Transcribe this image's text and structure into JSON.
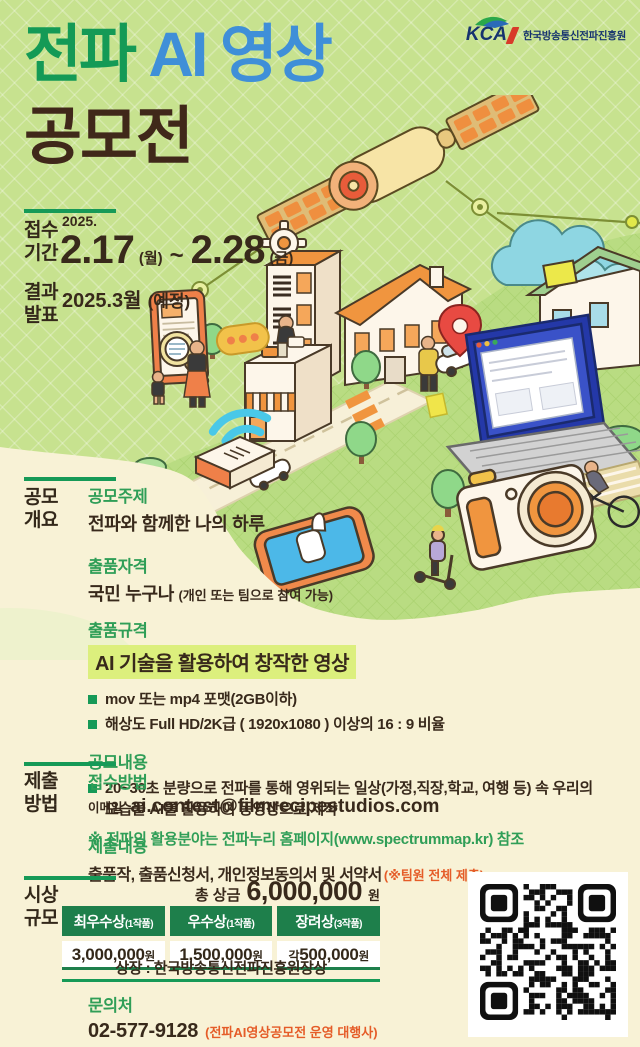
{
  "logo": {
    "kca": "KCA",
    "org": "한국방송통신전파진흥원"
  },
  "title": {
    "part_green": "전파",
    "part_blue": " AI 영상",
    "line2": "공모전"
  },
  "schedule": {
    "apply_label": "접수\n기간",
    "year": "2025.",
    "start": "2.17",
    "start_day": "(월)",
    "separator": "~",
    "end": "2.28",
    "end_day": "(금)",
    "result_label": "결과\n발표",
    "result": "2025.3월",
    "result_note": "(예정)"
  },
  "overview": {
    "label": "공모\n개요",
    "topic_heading": "공모주제",
    "topic": "전파와 함께한 나의 하루",
    "eligibility_heading": "출품자격",
    "eligibility": "국민 누구나",
    "eligibility_note": "(개인 또는 팀으로 참여 가능)",
    "spec_heading": "출품규격",
    "spec_highlight": "AI 기술을 활용하여 창작한 영상",
    "spec_items": [
      "mov 또는 mp4 포맷(2GB이하)",
      "해상도 Full HD/2K급 ( 1920x1080 ) 이상의 16 : 9 비율"
    ],
    "content_heading": "공모내용",
    "content_item": "20~30초 분량으로 전파를 통해 영위되는 일상(가정,직장,학교, 여행 등) 속 우리의 모습을 AI를 활용하여 동영상으로 제작",
    "reference": "※ 전파의 활용분야는 전파누리 홈페이지(www.spectrummap.kr) 참조"
  },
  "submission": {
    "label": "제출\n방법",
    "method_heading": "접수방법",
    "method_type": "이메일",
    "email": "ai.contest@filmrecipestudios.com",
    "content_heading": "제출내용",
    "content": "출품작, 출품신청서, 개인정보동의서 및 서약서",
    "content_note": "(※팀원 전체 제출)"
  },
  "awards": {
    "label": "시상\n규모",
    "total_label": "총 상금",
    "total_amount": "6,000,000",
    "total_unit": "원",
    "prizes": [
      {
        "name": "최우수상",
        "count": "(1작품)",
        "prefix": "",
        "amount": "3,000,000",
        "unit": "원"
      },
      {
        "name": "우수상",
        "count": "(1작품)",
        "prefix": "",
        "amount": "1,500,000",
        "unit": "원"
      },
      {
        "name": "장려상",
        "count": "(3작품)",
        "prefix": "각",
        "amount": "500,000",
        "unit": "원"
      }
    ],
    "certificate": "상장 : 한국방송통신전파진흥원장상"
  },
  "contact": {
    "heading": "문의처",
    "phone": "02-577-9128",
    "note": "(전파AI영상공모전 운영 대행사)"
  },
  "colors": {
    "title_green": "#149a56",
    "title_blue": "#3f8fd8",
    "title_brown": "#40281a",
    "heading_green": "#2f9e57",
    "section_line_green": "#169a57",
    "table_header_green": "#1e7f4b",
    "highlight_yellow_green": "#dcef7d",
    "note_orange": "#e55c28",
    "bg_top_green": "#c7e28f",
    "bg_cream": "#f8f2d6",
    "logo_navy": "#16336e"
  }
}
